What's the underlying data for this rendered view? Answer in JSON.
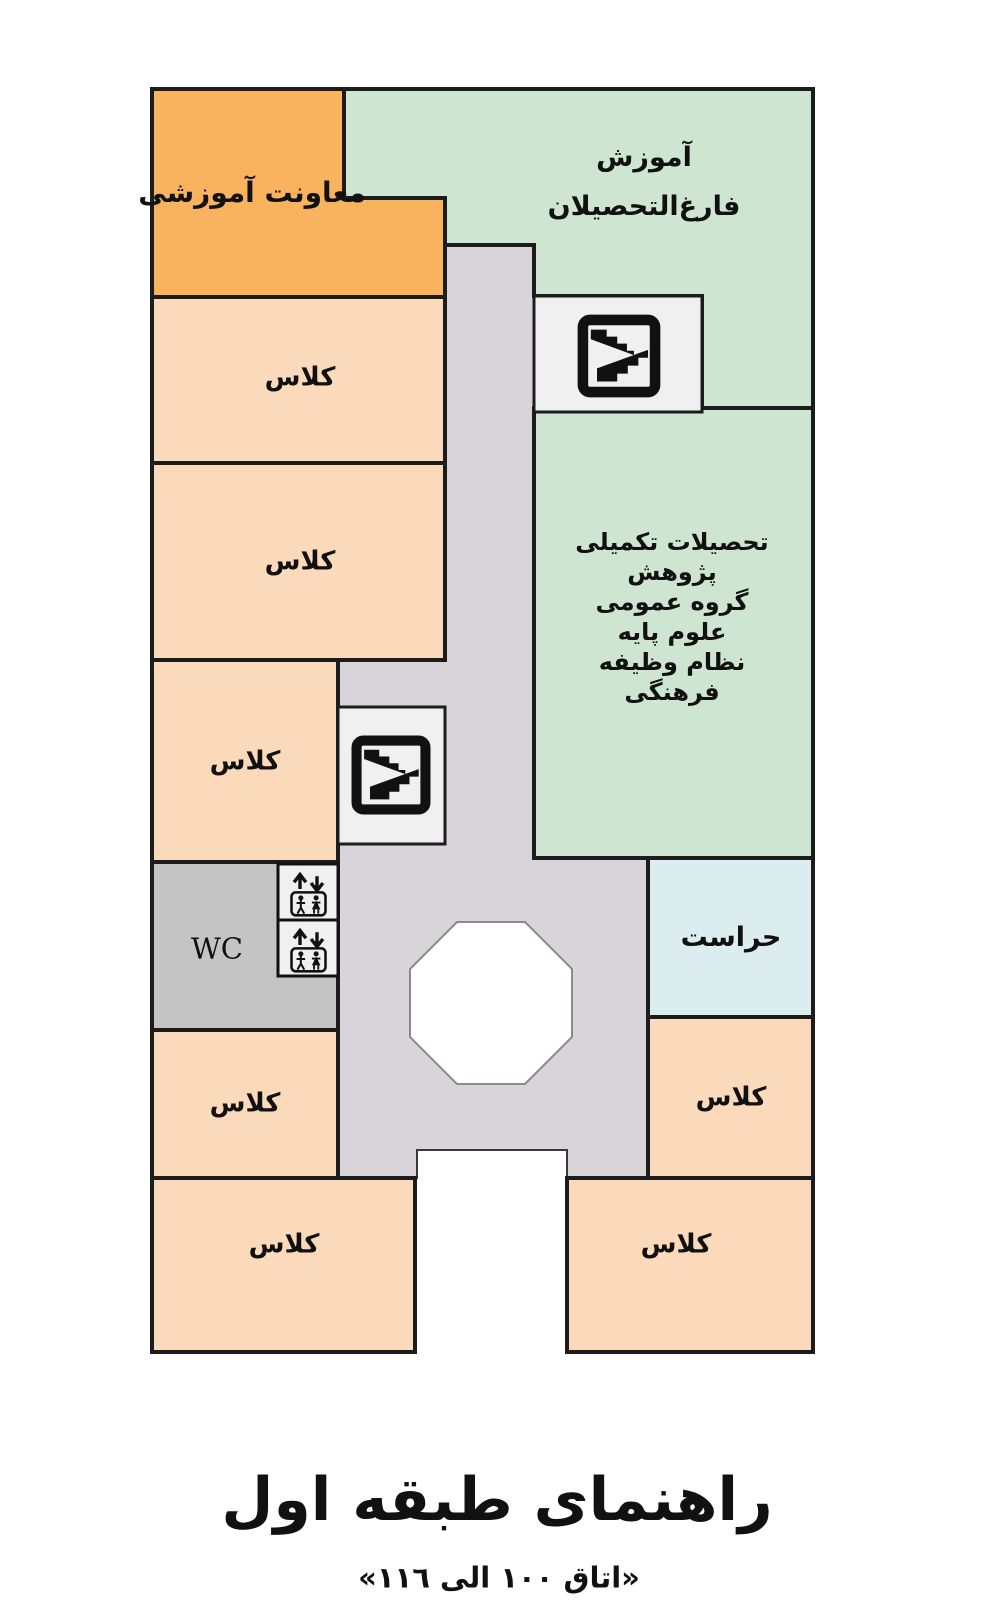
{
  "title": {
    "heading": "راهنمای طبقه اول",
    "subtitle": "«اتاق ١٠٠ الی ١١٦»"
  },
  "rooms": {
    "deputy": {
      "label": "معاونت آموزشی"
    },
    "graduates": {
      "lines": [
        "آموزش",
        "فارغ‌التحصیلان"
      ]
    },
    "graduate_studies": {
      "lines": [
        "تحصیلات تکمیلی",
        "پژوهش",
        "گروه عمومی",
        "علوم پایه",
        "نظام وظیفه",
        "فرهنگی"
      ]
    },
    "security": {
      "label": "حراست"
    },
    "wc": {
      "label": "WC"
    },
    "classes": [
      "کلاس",
      "کلاس",
      "کلاس",
      "کلاس",
      "کلاس",
      "کلاس",
      "کلاس"
    ]
  },
  "icons": {
    "stairs": "stairs-icon",
    "elevator": "elevator-icon"
  },
  "colors": {
    "orange": "#F9B25E",
    "peach": "#FBD9BB",
    "green": "#CEE5D2",
    "corridor": "#D8D4D9",
    "stair_room": "#F0F0F0",
    "wc_gray": "#C4C4C4",
    "security_blue": "#DCEDEF",
    "octagon": "#FFFFFF",
    "border": "#1C1C1C"
  }
}
